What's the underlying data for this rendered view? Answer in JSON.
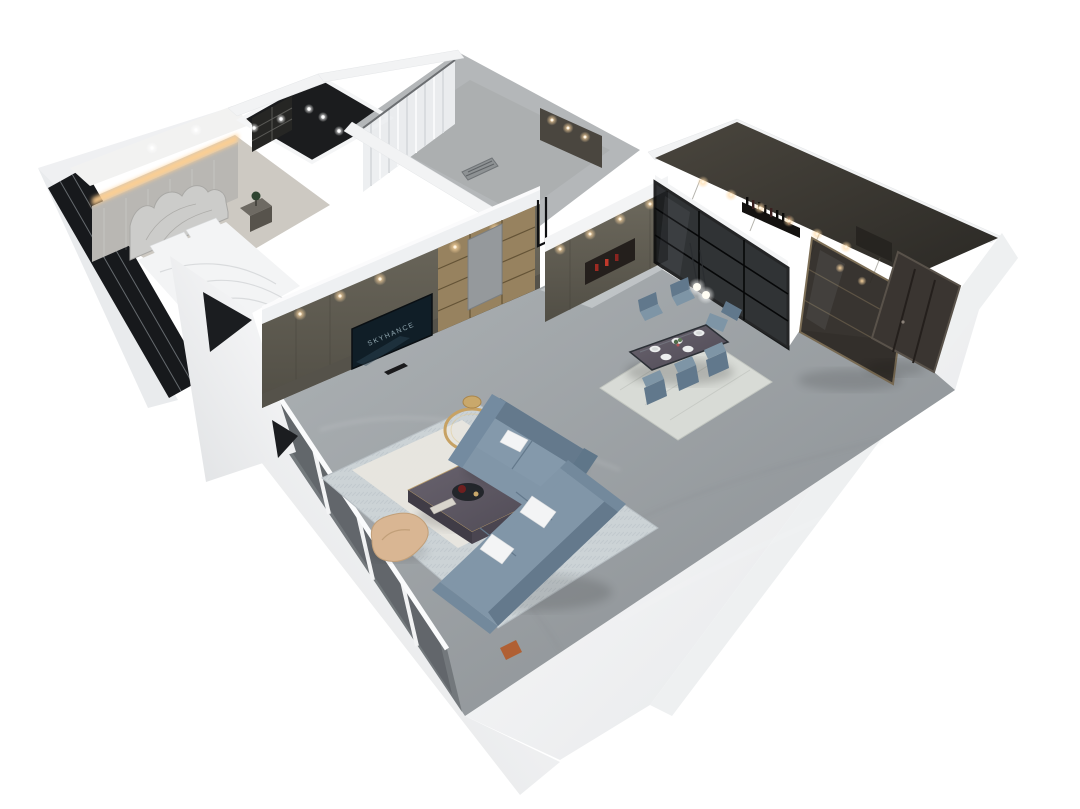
{
  "scene": {
    "type": "3d-apartment-floorplan-render",
    "style": "isometric dollhouse cutaway render, white background",
    "background": "#ffffff"
  },
  "living_room": {
    "tv_screen_text": "SKYHANCE"
  },
  "palette": {
    "page_bg": "#ffffff",
    "wall_light": "#f2f3f4",
    "wall_shade": "#e3e5e7",
    "floor_marble_light": "#aeb3b6",
    "floor_marble_dark": "#878c90",
    "floor_bedroom": "#cdc9c2",
    "floor_tile": "#b4b7b9",
    "rug_living": "#ccd3d6",
    "rug_ivory": "#e8e6df",
    "rug_dining": "#d8dbd6",
    "sofa_blue": "#8196a8",
    "sofa_blue_dark": "#64798c",
    "chair_blue": "#7e95a6",
    "armchair_tan": "#d9b693",
    "cabinet_olive": "#6e6a5e",
    "cabinet_olive_dark": "#514e45",
    "wood_shelf": "#97825f",
    "kitchen_dark": "#3a3731",
    "glass_dark": "#17191c",
    "table_dark": "#3d4249",
    "door_dark": "#3a3531",
    "gold_accent": "#c7a264",
    "warm_light": "#ffd9a3",
    "red_accent": "#9c2a22"
  }
}
